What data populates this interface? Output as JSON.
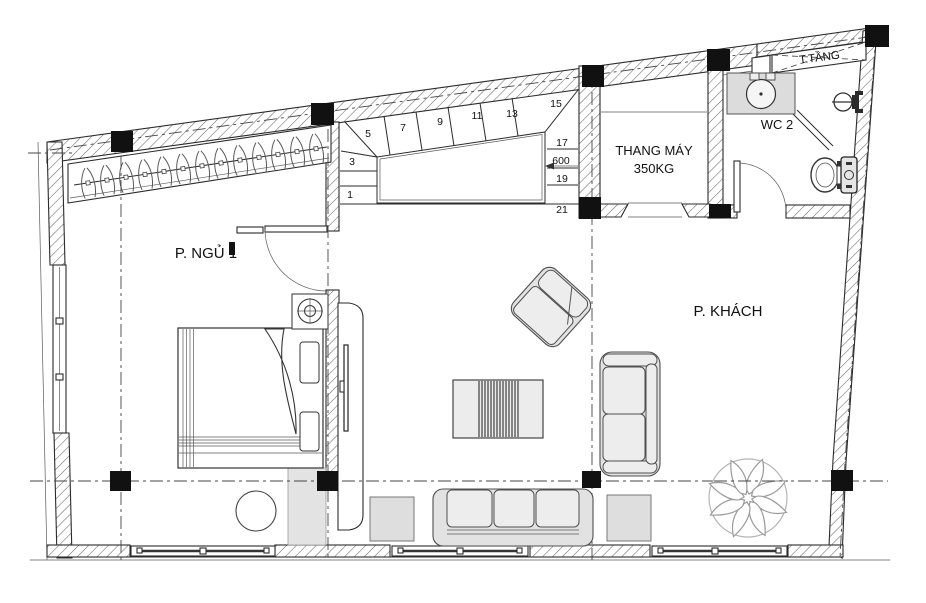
{
  "title": "Apartment floor plan",
  "rooms": {
    "bedroom_label": "P. NGỦ 1",
    "living_label": "P. KHÁCH",
    "elevator_label_line1": "THANG MÁY",
    "elevator_label_line2": "350KG",
    "wc_label": "WC 2",
    "mezzanine_label": "T.TẦNG"
  },
  "stairs": {
    "numbers": [
      "1",
      "3",
      "5",
      "7",
      "9",
      "11",
      "13",
      "15",
      "17",
      "600",
      "19",
      "21"
    ]
  },
  "colors": {
    "background": "#ffffff",
    "line": "#2b2b2b",
    "wall_hatch_line": "#6b6b6b",
    "column_fill": "#111111",
    "furniture_fill": "#e2e2e2",
    "furniture_fill_light": "#ededed",
    "counter_fill": "#dcdcdc",
    "coffee_table_stripe": "#3f3f3f",
    "centerline": "#454545",
    "text": "#111111"
  }
}
